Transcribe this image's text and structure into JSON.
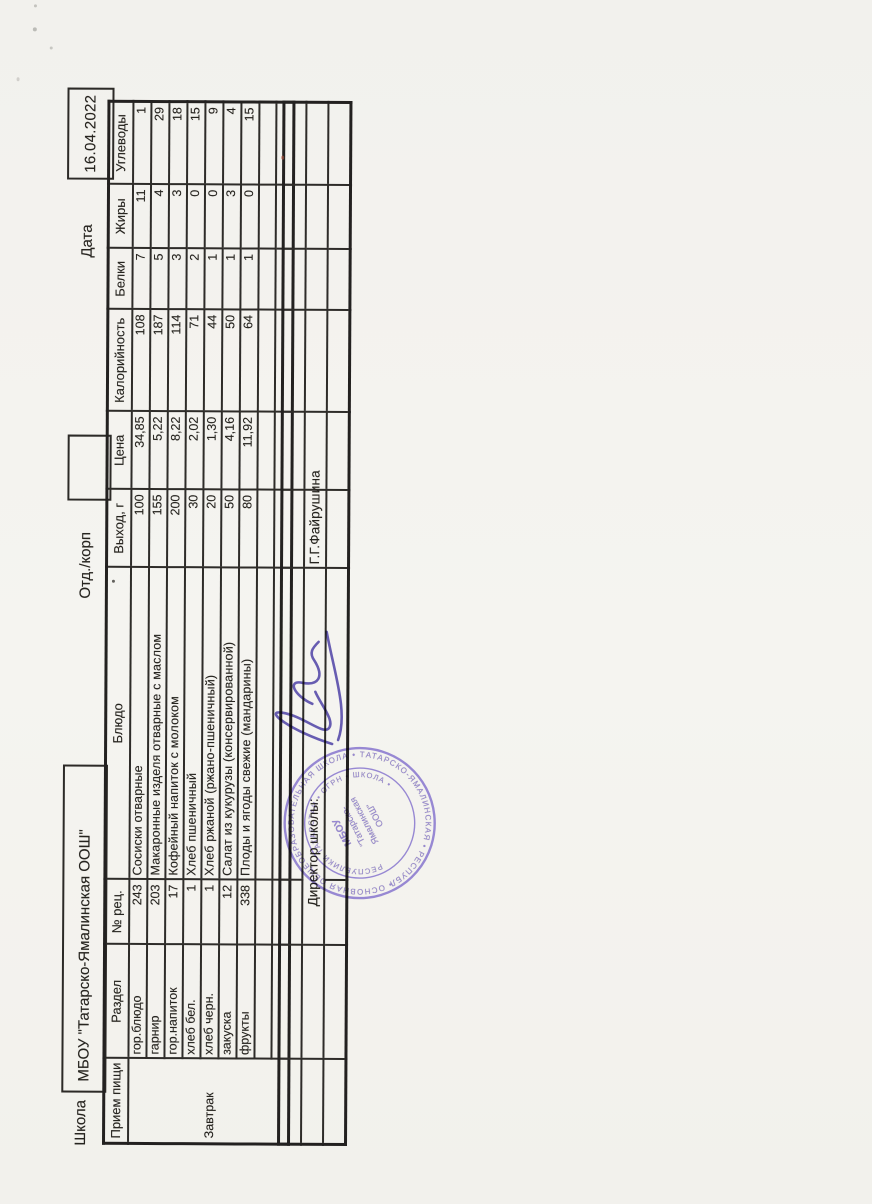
{
  "header": {
    "school_label": "Школа",
    "school_name": "МБОУ \"Татарско-Ямалинская ООШ\"",
    "dept_label": "Отд./корп",
    "dept_value": "",
    "date_label": "Дата",
    "date_value": "16.04.2022"
  },
  "table": {
    "headers": [
      "Прием пищи",
      "Раздел",
      "№ рец.",
      "Блюдо",
      "Выход, г",
      "Цена",
      "Калорийность",
      "Белки",
      "Жиры",
      "Углеводы"
    ],
    "meal": "Завтрак",
    "rows": [
      {
        "section": "гор.блюдо",
        "rec": "243",
        "dish": "Сосиски отварные",
        "out": "100",
        "price": "34,85",
        "kcal": "108",
        "protein": "7",
        "fat": "11",
        "carbs": "1"
      },
      {
        "section": "гарнир",
        "rec": "203",
        "dish": "Макаронные изделя отварные с маслом",
        "out": "155",
        "price": "5,22",
        "kcal": "187",
        "protein": "5",
        "fat": "4",
        "carbs": "29"
      },
      {
        "section": "гор.напиток",
        "rec": "17",
        "dish": "Кофейный напиток с молоком",
        "out": "200",
        "price": "8,22",
        "kcal": "114",
        "protein": "3",
        "fat": "3",
        "carbs": "18"
      },
      {
        "section": "хлеб бел.",
        "rec": "1",
        "dish": "Хлеб пшеничный",
        "out": "30",
        "price": "2,02",
        "kcal": "71",
        "protein": "2",
        "fat": "0",
        "carbs": "15"
      },
      {
        "section": "хлеб черн.",
        "rec": "1",
        "dish": "Хлеб ржаной (ржано-пшеничный)",
        "out": "20",
        "price": "1,30",
        "kcal": "44",
        "protein": "1",
        "fat": "0",
        "carbs": "9"
      },
      {
        "section": "закуска",
        "rec": "12",
        "dish": "Салат из кукурузы (консервированной)",
        "out": "50",
        "price": "4,16",
        "kcal": "50",
        "protein": "1",
        "fat": "3",
        "carbs": "4"
      },
      {
        "section": "фрукты",
        "rec": "338",
        "dish": "Плоды и ягоды свежие (мандарины)",
        "out": "80",
        "price": "11,92",
        "kcal": "64",
        "protein": "1",
        "fat": "0",
        "carbs": "15"
      }
    ]
  },
  "footer": {
    "director_label": "Директор школы:",
    "director_name": "Г.Г.Файрушина"
  },
  "stamp": {
    "ring_text": "• ОСНОВНАЯ ОБЩЕОБРАЗОВАТЕЛЬНАЯ ШКОЛА • ТАТАРСКО-ЯМАЛИНСКАЯ • РЕСПУБЛИКИ ТАТАРСТАН ",
    "inner_ring_text": "РЕСПУБЛИКИ ТАТАРСТАН • ОГРН • ШКОЛА •",
    "center": [
      "МБОУ",
      "\"Татарско-",
      "Ямалинская",
      "ООШ\""
    ]
  },
  "colors": {
    "paper": "#f3f2ee",
    "ink": "#26241f",
    "stamp": "#7c69cb",
    "signature": "#4a3da5"
  }
}
